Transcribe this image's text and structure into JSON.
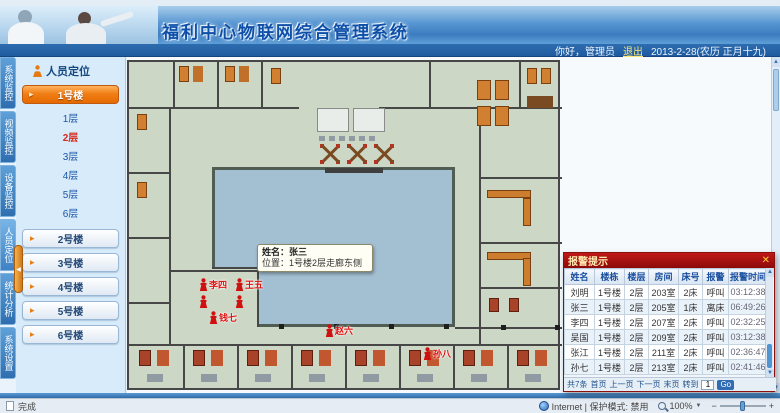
{
  "icons": {
    "close": "✕",
    "up": "▲",
    "down": "▼",
    "left": "◀",
    "zoom_out": "−",
    "zoom_in": "+",
    "dropdown": "▼"
  },
  "header": {
    "title": "福利中心物联网综合管理系统",
    "greeting": "你好，管理员",
    "logout": "退出",
    "date": "2013-2-28(农历 正月十九)"
  },
  "modules": {
    "active_index": 3,
    "items": [
      "系统监控",
      "视频监控",
      "设备监控",
      "人员定位",
      "统计分析",
      "系统设置"
    ]
  },
  "sidebar": {
    "title": "人员定位",
    "active_building": "1号楼",
    "floors": [
      "1层",
      "2层",
      "3层",
      "4层",
      "5层",
      "6层"
    ],
    "active_floor": "2层",
    "other_buildings": [
      "2号楼",
      "3号楼",
      "4号楼",
      "5号楼",
      "6号楼"
    ]
  },
  "floorplan": {
    "tooltip": {
      "line1": "姓名：张三",
      "line2": "位置：1号楼2层走廊东侧"
    },
    "markers": [
      {
        "x": 70,
        "y": 216,
        "label": "李四"
      },
      {
        "x": 106,
        "y": 216,
        "label": "王五"
      },
      {
        "x": 70,
        "y": 233,
        "label": ""
      },
      {
        "x": 106,
        "y": 233,
        "label": ""
      },
      {
        "x": 80,
        "y": 249,
        "label": "钱七"
      },
      {
        "x": 196,
        "y": 262,
        "label": "赵六"
      },
      {
        "x": 294,
        "y": 285,
        "label": "孙八"
      }
    ]
  },
  "alarm_panel": {
    "title": "报警提示",
    "columns": [
      "姓名",
      "楼栋",
      "楼层",
      "房间",
      "床号",
      "报警",
      "报警时间"
    ],
    "rows": [
      {
        "name": "刘明",
        "building": "1号楼",
        "floor": "2层",
        "room": "203室",
        "bed": "2床",
        "alarm": "呼叫",
        "time": "03:12:38"
      },
      {
        "name": "张三",
        "building": "1号楼",
        "floor": "2层",
        "room": "205室",
        "bed": "1床",
        "alarm": "离床",
        "time": "06:49:26"
      },
      {
        "name": "李四",
        "building": "1号楼",
        "floor": "2层",
        "room": "207室",
        "bed": "2床",
        "alarm": "呼叫",
        "time": "02:32:25"
      },
      {
        "name": "吴国",
        "building": "1号楼",
        "floor": "2层",
        "room": "209室",
        "bed": "2床",
        "alarm": "呼叫",
        "time": "03:12:38"
      },
      {
        "name": "张江",
        "building": "1号楼",
        "floor": "2层",
        "room": "211室",
        "bed": "2床",
        "alarm": "呼叫",
        "time": "02:36:47"
      },
      {
        "name": "孙七",
        "building": "1号楼",
        "floor": "2层",
        "room": "213室",
        "bed": "2床",
        "alarm": "呼叫",
        "time": "02:41:46"
      }
    ],
    "pager": {
      "info": "共7条",
      "first": "首页",
      "prev": "上一页",
      "next": "下一页",
      "last": "末页",
      "goto_label": "转到",
      "page": "1",
      "go": "Go"
    }
  },
  "statusbar": {
    "left": "完成",
    "zone": "Internet | 保护模式: 禁用",
    "zoom": "100%"
  }
}
